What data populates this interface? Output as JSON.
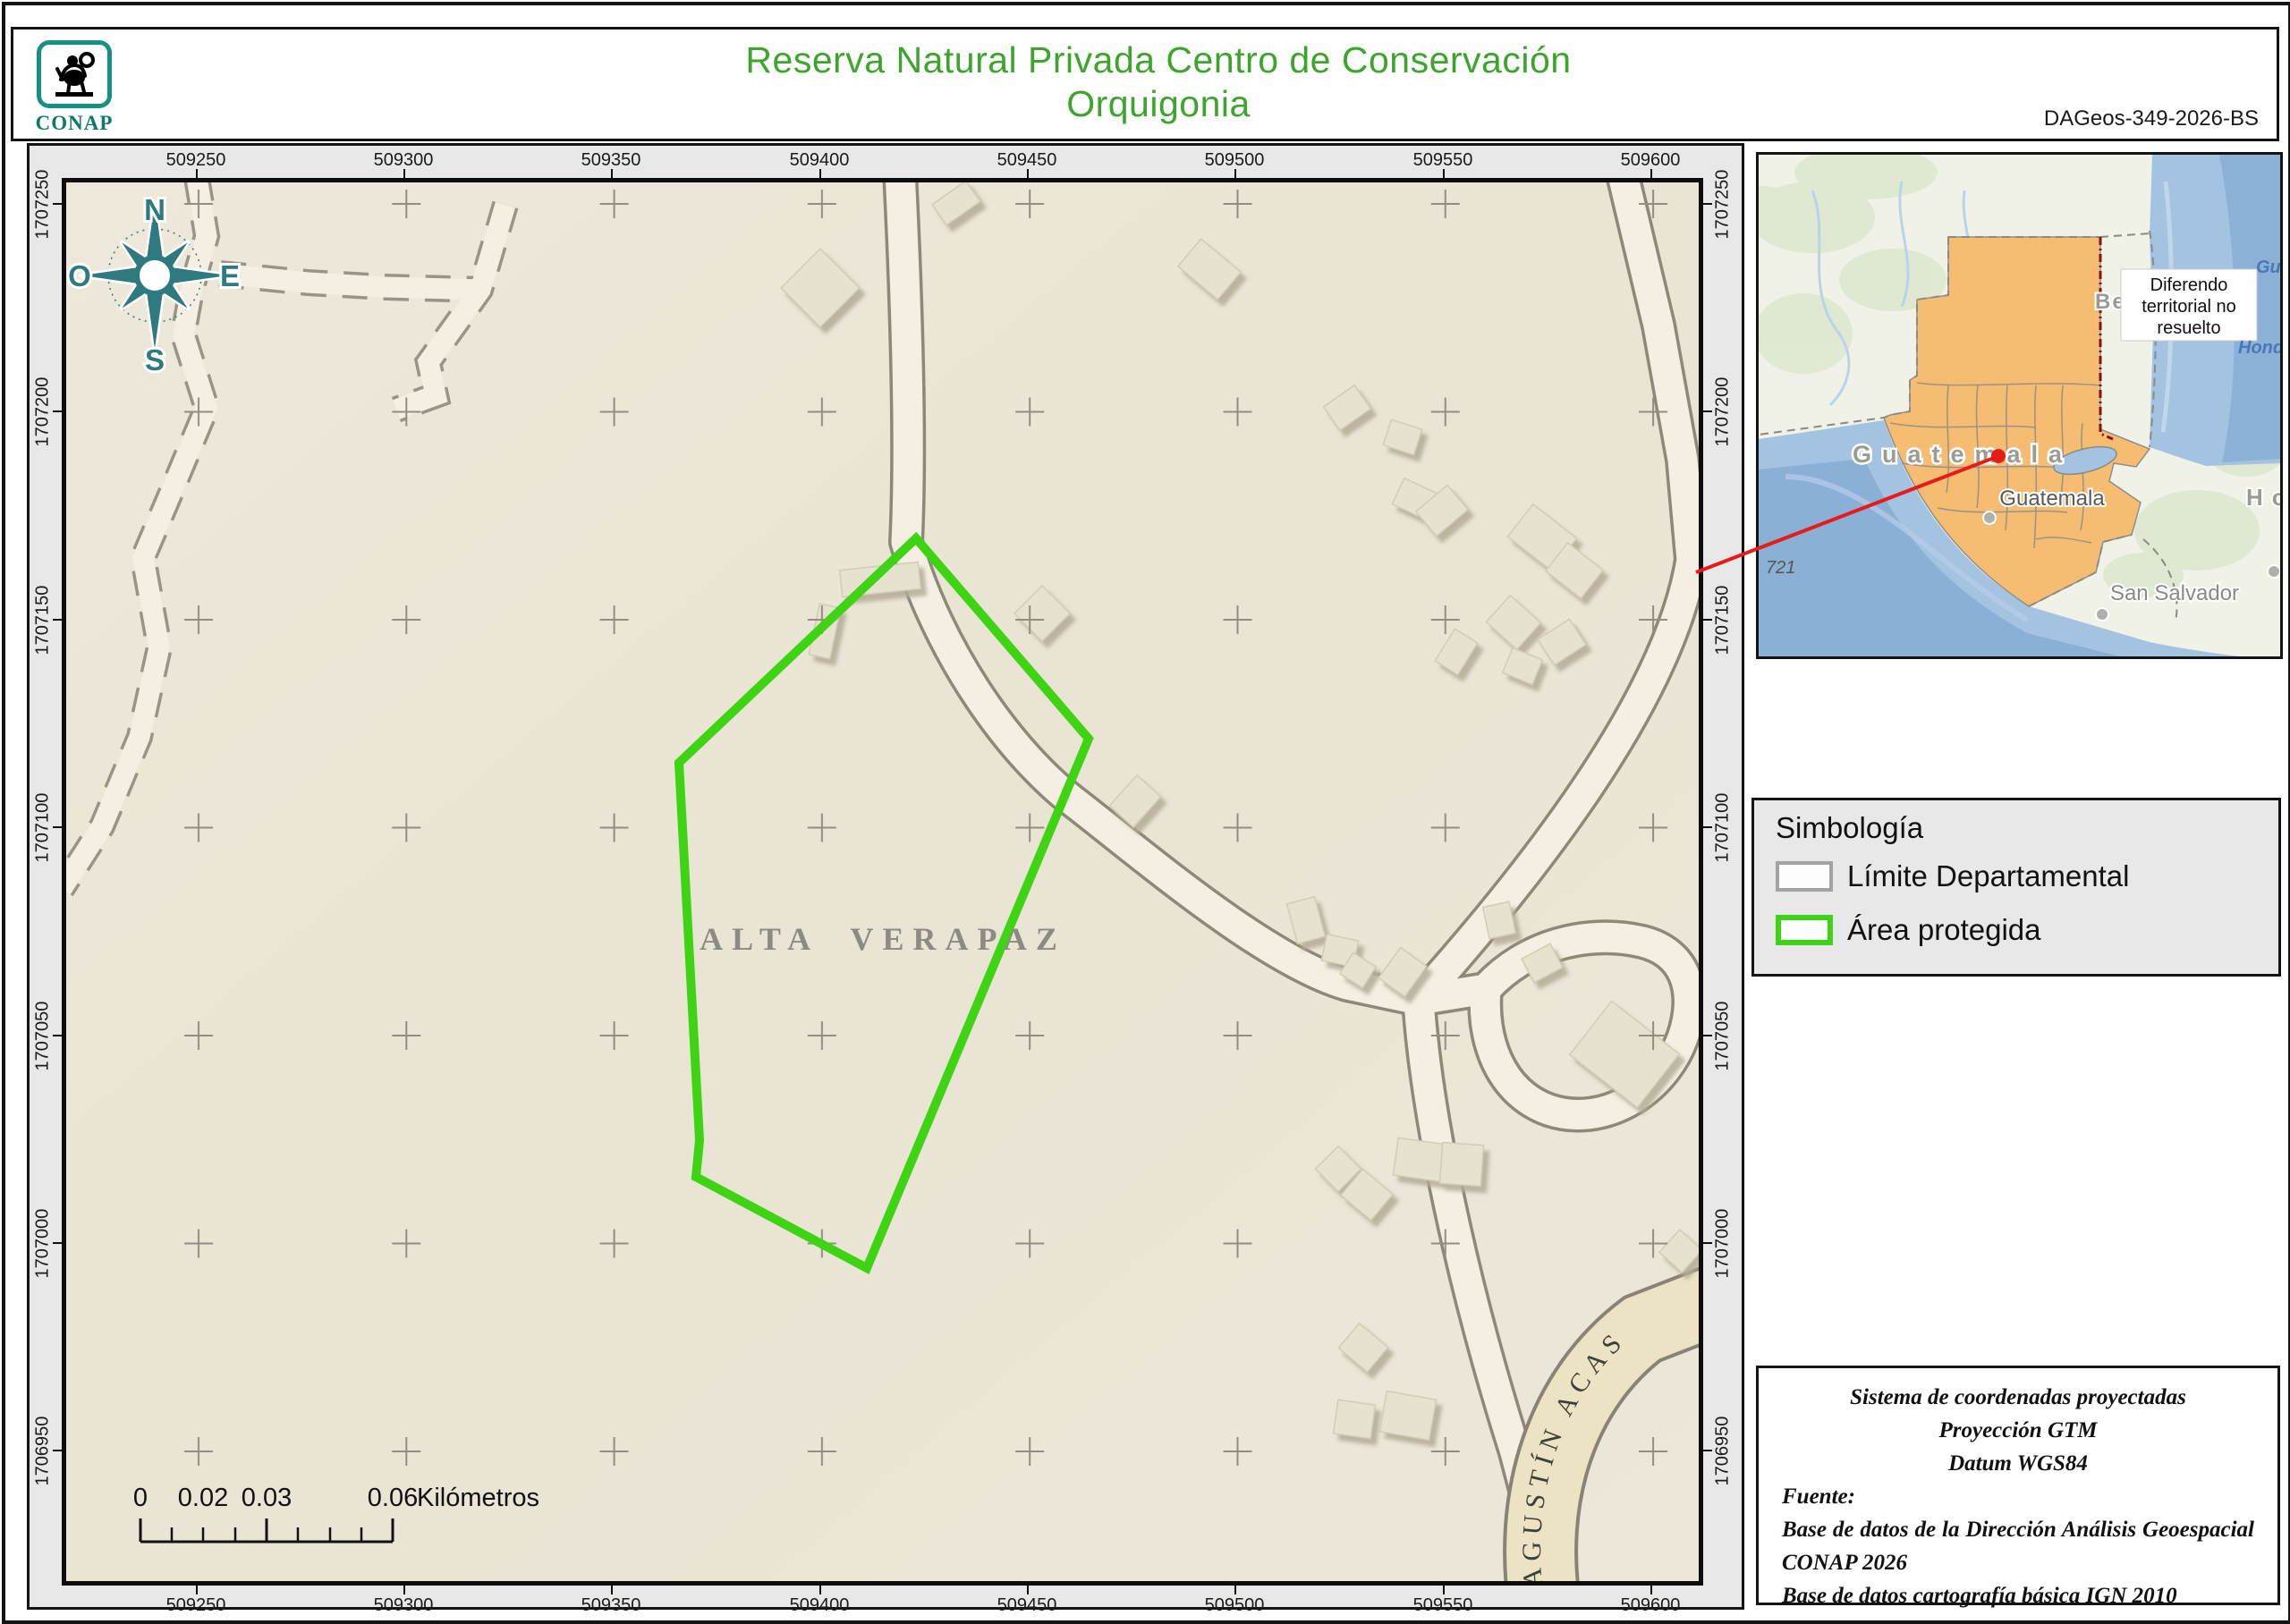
{
  "header": {
    "logo_text": "CONAP",
    "title_line1": "Reserva Natural Privada Centro de Conservación",
    "title_line2": "Orquigonia",
    "doc_code": "DAGeos-349-2026-BS"
  },
  "map": {
    "x_labels": [
      "509250",
      "509300",
      "509350",
      "509400",
      "509450",
      "509500",
      "509550",
      "509600"
    ],
    "y_labels": [
      "1707250",
      "1707200",
      "1707150",
      "1707100",
      "1707050",
      "1707000",
      "1706950"
    ],
    "region_label": "ALTA VERAPAZ",
    "road_label": "AGUSTÍN ACAS",
    "protected_area_points": "950,398 1143,622 895,1214 704,1112 708,1071 685,649",
    "compass": {
      "n": "N",
      "e": "E",
      "s": "S",
      "o": "O"
    },
    "scale_bar": {
      "l0": "0",
      "l1": "0.02",
      "l2": "0.03",
      "l3": "0.06",
      "unit": "Kilómetros"
    }
  },
  "inset": {
    "country_label": "Guatemala",
    "city_label": "Guatemala",
    "city2_label": "San Salvador",
    "belize_label": "Belice",
    "honduras_label": "Honduras",
    "sea_label1": "Gu",
    "sea_label2": "Hond",
    "depth_note": "721",
    "callout_line1": "Diferendo",
    "callout_line2": "territorial no",
    "callout_line3": "resuelto"
  },
  "legend": {
    "title": "Simbología",
    "item1_label": "Límite Departamental",
    "item2_label": "Área protegida"
  },
  "info_box": {
    "line1": "Sistema de coordenadas proyectadas",
    "line2": "Proyección GTM",
    "line3": "Datum WGS84",
    "source_label": "Fuente:",
    "source1": "Base de datos de la Dirección Análisis Geoespacial",
    "source2": "CONAP 2026",
    "source3": "Base de datos cartografía básica IGN 2010"
  },
  "colors": {
    "title_green": "#3da52c",
    "protected_area_green": "#3ed414",
    "compass_teal": "#2e7a7e",
    "logo_teal": "#149182",
    "guatemala_orange": "#f6bc72",
    "sea_blue": "#a3c3e0",
    "red_leader": "#e51c18",
    "map_beige": "#ece7d9"
  }
}
